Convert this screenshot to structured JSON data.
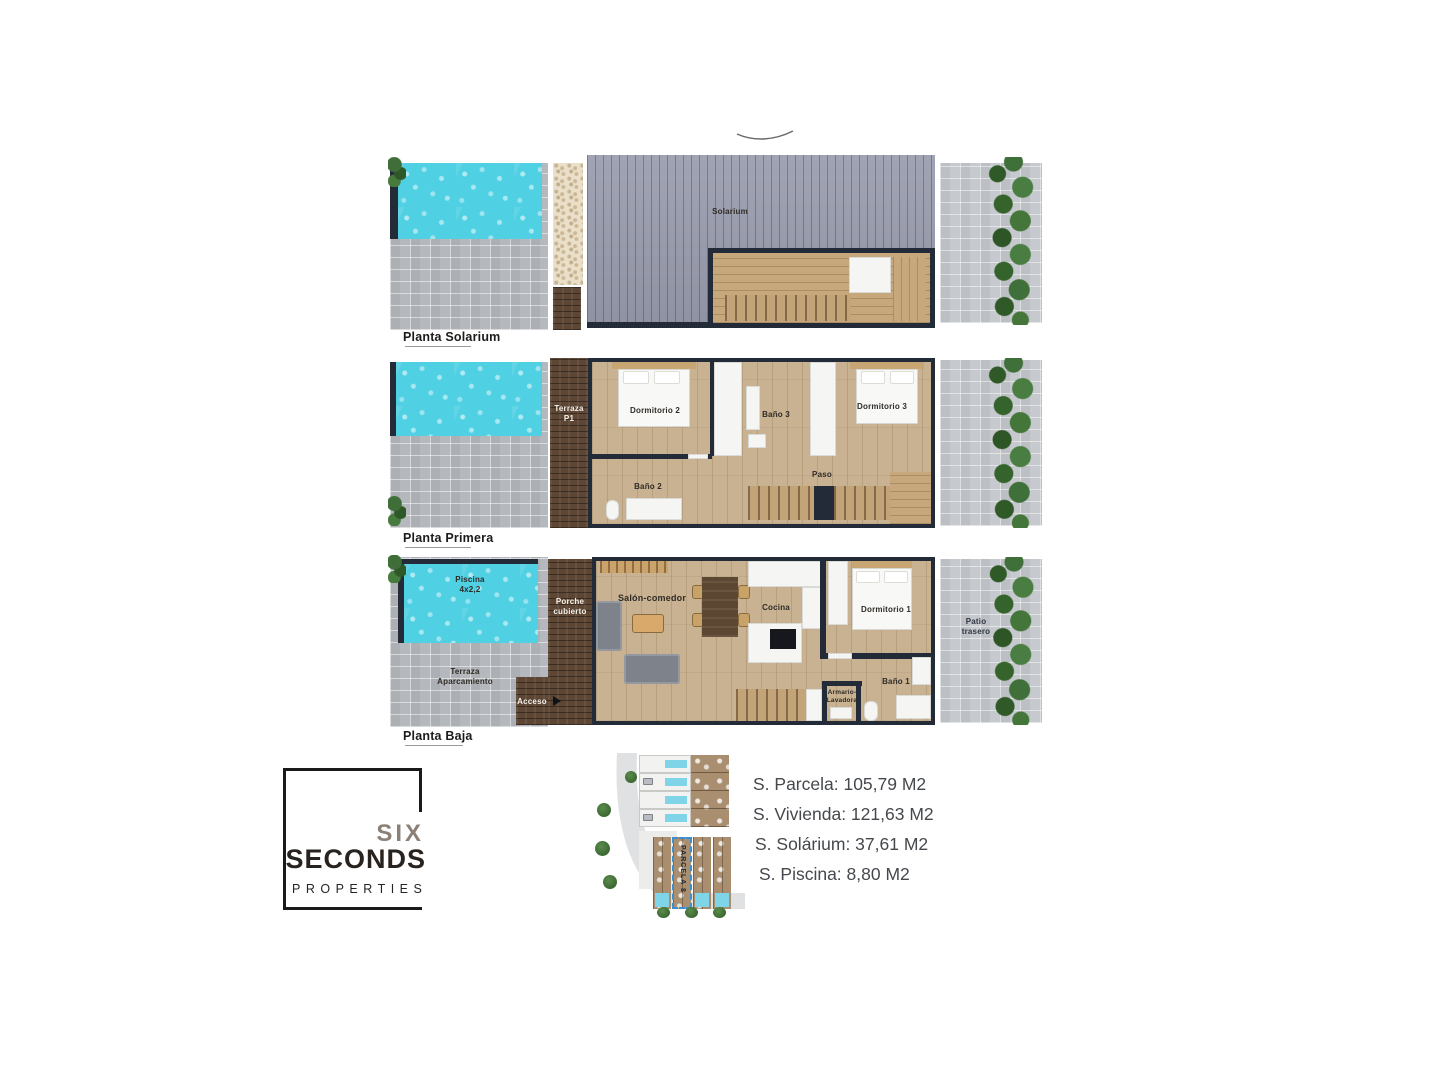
{
  "document": {
    "type": "floor-plan brochure"
  },
  "plans": [
    {
      "title": "Planta Solarium",
      "labels": {
        "solarium": "Solarium"
      }
    },
    {
      "title": "Planta Primera",
      "labels": {
        "terraza": "Terraza\nP1",
        "dormitorio2": "Dormitorio 2",
        "bano3": "Baño 3",
        "dormitorio3": "Dormitorio 3",
        "paso": "Paso",
        "bano2": "Baño 2"
      }
    },
    {
      "title": "Planta Baja",
      "labels": {
        "piscina": "Piscina\n4x2,2",
        "terraza_aparcamiento": "Terraza\nAparcamiento",
        "porche": "Porche\ncubierto",
        "acceso": "Acceso",
        "salon": "Salón-comedor",
        "cocina": "Cocina",
        "dormitorio1": "Dormitorio 1",
        "bano1": "Baño 1",
        "armario": "Armario-\nLavadora",
        "patio": "Patio\ntrasero"
      }
    }
  ],
  "siteplan": {
    "parcel_label": "PARCELA 8"
  },
  "stats": {
    "lines": [
      "S. Parcela: 105,79 M2",
      "S. Vivienda: 121,63 M2",
      "S. Solárium: 37,61 M2",
      "S. Piscina: 8,80 M2"
    ]
  },
  "logo": {
    "line1": "SIX",
    "line2": "SECONDS",
    "line3": "PROPERTIES"
  },
  "colors": {
    "pool": "#4fd0e3",
    "wall": "#232b39",
    "deck": "#9a9dae",
    "wood_terrace": "#5d4634",
    "interior_floor": "#c8b292",
    "pavers": "#b5b9be",
    "tree_green": "#40703a",
    "logo_six": "#8a8076",
    "logo_dark": "#29231f",
    "parcel_highlight": "#3a8fd0",
    "stats_text": "#45484c"
  }
}
